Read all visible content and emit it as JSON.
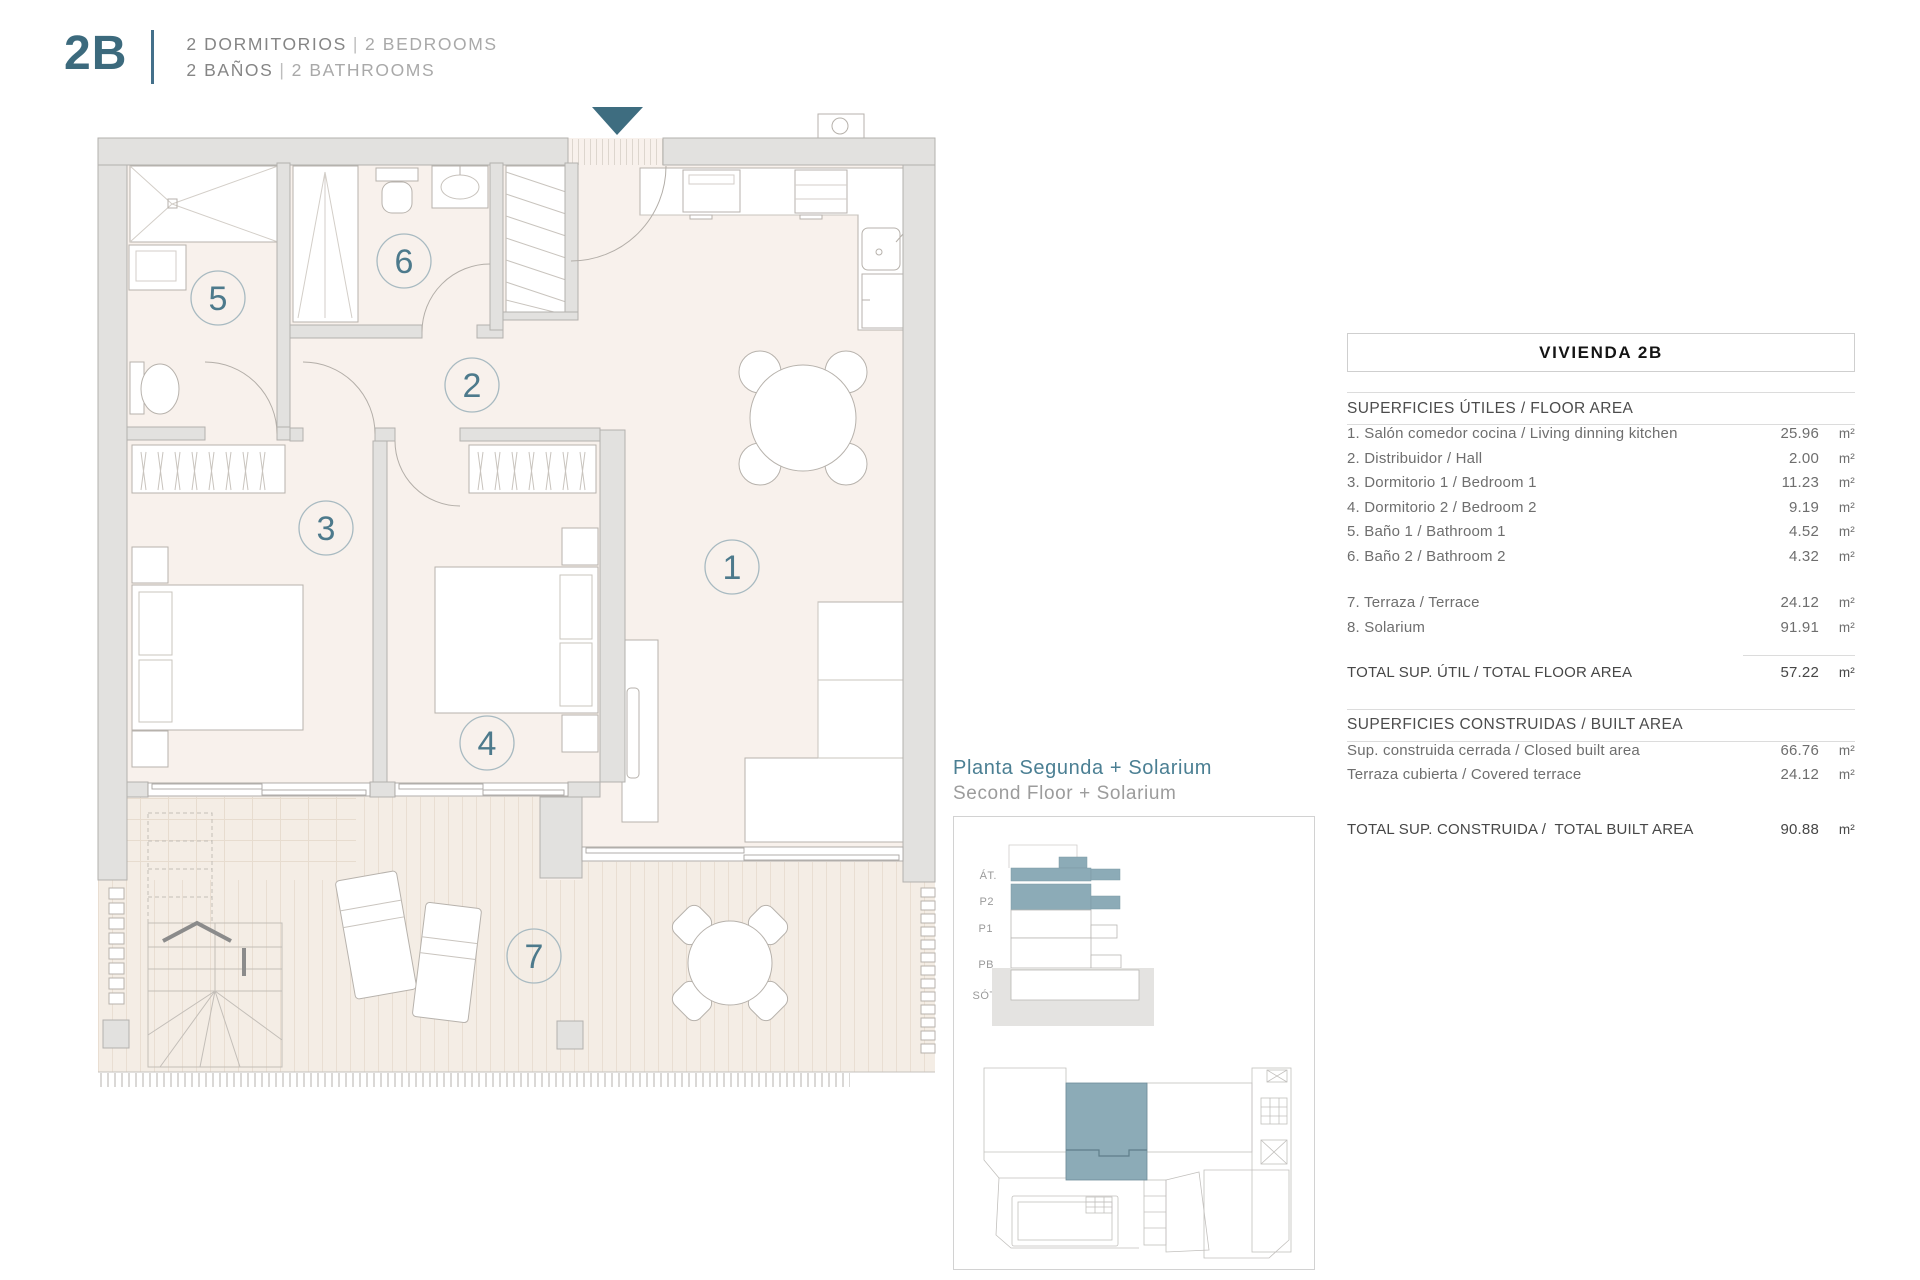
{
  "header": {
    "unit": "2B",
    "rooms_es": "2 DORMITORIOS",
    "rooms_en": "2 BEDROOMS",
    "baths_es": "2 BAÑOS",
    "baths_en": "2 BATHROOMS",
    "divider": "|"
  },
  "plan": {
    "room_numbers": [
      "1",
      "2",
      "3",
      "4",
      "5",
      "6",
      "7"
    ]
  },
  "inset": {
    "title_es": "Planta Segunda + Solarium",
    "title_en": "Second Floor + Solarium",
    "levels": [
      "ÁT.",
      "P2",
      "P1",
      "PB",
      "SÓT."
    ]
  },
  "table": {
    "title": "VIVIENDA 2B",
    "floor_section": {
      "header": "SUPERFICIES ÚTILES / FLOOR AREA",
      "rows": [
        {
          "label": "1. Salón comedor cocina / Living dinning kitchen",
          "value": "25.96",
          "unit": "m²"
        },
        {
          "label": "2. Distribuidor / Hall",
          "value": "2.00",
          "unit": "m²"
        },
        {
          "label": "3. Dormitorio 1 / Bedroom 1",
          "value": "11.23",
          "unit": "m²"
        },
        {
          "label": "4. Dormitorio 2 / Bedroom 2",
          "value": "9.19",
          "unit": "m²"
        },
        {
          "label": "5. Baño 1 / Bathroom 1",
          "value": "4.52",
          "unit": "m²"
        },
        {
          "label": "6. Baño 2 / Bathroom 2",
          "value": "4.32",
          "unit": "m²"
        },
        {
          "label": "7. Terraza / Terrace",
          "value": "24.12",
          "unit": "m²"
        },
        {
          "label": "8. Solarium",
          "value": "91.91",
          "unit": "m²"
        }
      ],
      "total": {
        "label": "TOTAL SUP. ÚTIL / TOTAL FLOOR AREA",
        "value": "57.22",
        "unit": "m²"
      }
    },
    "built_section": {
      "header": "SUPERFICIES CONSTRUIDAS / BUILT AREA",
      "rows": [
        {
          "label": "Sup. construida cerrada / Closed built area",
          "value": "66.76",
          "unit": "m²"
        },
        {
          "label": "Terraza cubierta / Covered terrace",
          "value": "24.12",
          "unit": "m²"
        }
      ],
      "total": {
        "label": "TOTAL SUP. CONSTRUIDA /  TOTAL BUILT AREA",
        "value": "90.88",
        "unit": "m²"
      }
    }
  },
  "colors": {
    "accent": "#3e6d80",
    "highlight": "#8cabb7"
  }
}
